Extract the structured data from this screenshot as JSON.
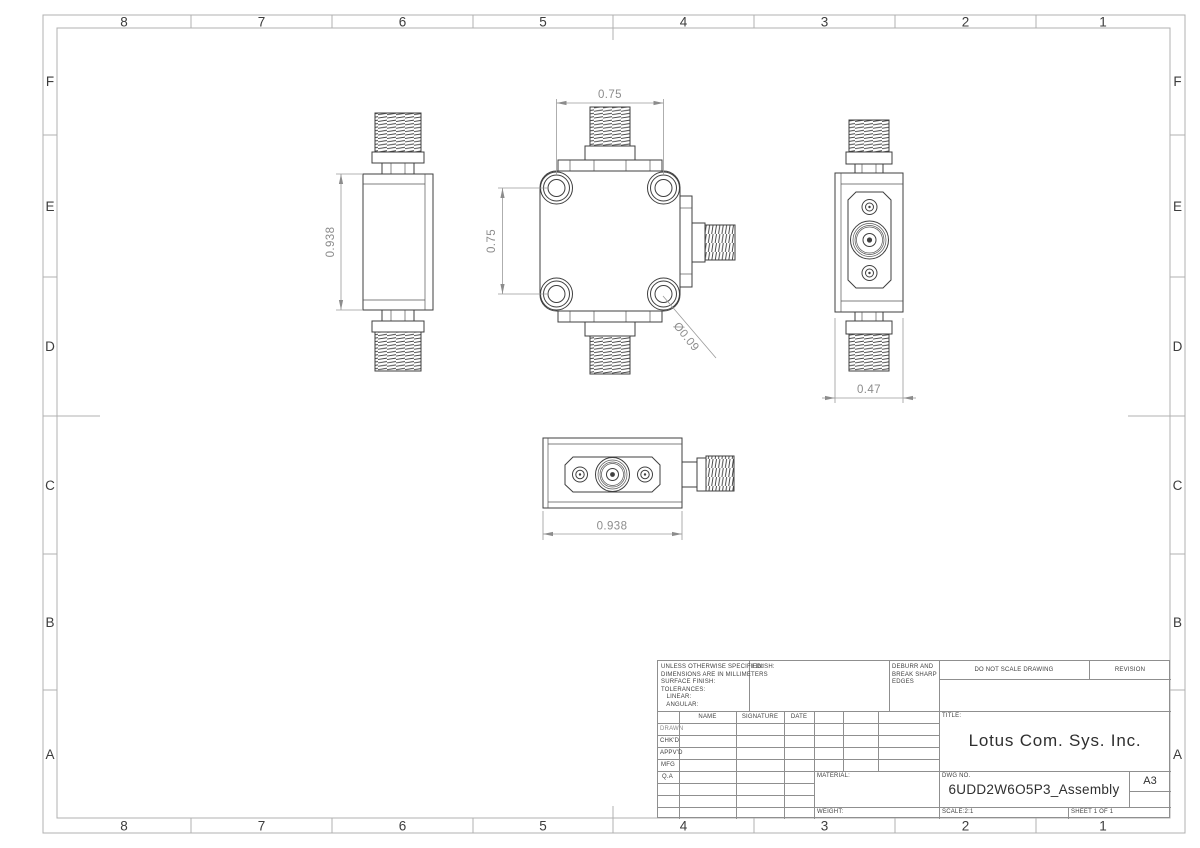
{
  "grid": {
    "cols": [
      "8",
      "7",
      "6",
      "5",
      "4",
      "3",
      "2",
      "1"
    ],
    "rows": [
      "F",
      "E",
      "D",
      "C",
      "B",
      "A"
    ]
  },
  "dims": {
    "front_hole_pitch_h": "0.75",
    "front_hole_pitch_v": "0.75",
    "hole_diameter": "Ø0.09",
    "side_height": "0.938",
    "bottom_width": "0.938",
    "body_depth": "0.47"
  },
  "title_block": {
    "spec_note": "UNLESS OTHERWISE SPECIFIED:\nDIMENSIONS ARE IN MILLIMETERS\nSURFACE FINISH:\nTOLERANCES:\n   LINEAR:\n   ANGULAR:",
    "finish_label": "FINISH:",
    "deburr_note": "DEBURR AND\nBREAK SHARP\nEDGES",
    "do_not_scale": "DO NOT SCALE DRAWING",
    "revision_label": "REVISION",
    "col_name": "NAME",
    "col_signature": "SIGNATURE",
    "col_date": "DATE",
    "approval_rows": [
      "DRAWN",
      "CHK'D",
      "APPV'D",
      "MFG",
      "Q.A"
    ],
    "material_label": "MATERIAL:",
    "weight_label": "WEIGHT:",
    "title_label": "TITLE:",
    "company": "Lotus Com. Sys. Inc.",
    "dwg_label": "DWG NO.",
    "dwg_no": "6UDD2W6O5P3_Assembly",
    "paper_size": "A3",
    "scale": "SCALE:2:1",
    "sheet": "SHEET 1 OF 1"
  },
  "colors": {
    "part_line": "#3f3f3f",
    "dim_line": "#9a9a9a",
    "dim_text": "#8c8c8c",
    "frame_line": "#b0b0b0",
    "label_text": "#3d3d3d"
  }
}
